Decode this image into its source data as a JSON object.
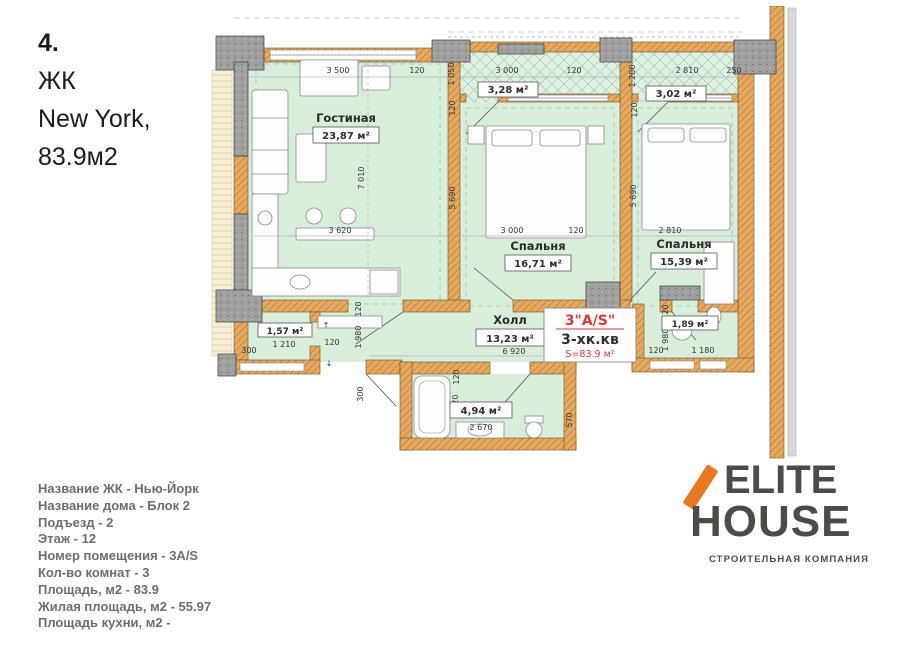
{
  "title": {
    "number": "4.",
    "lines": [
      "ЖК",
      "New York,",
      "83.9м2"
    ]
  },
  "plan": {
    "rooms": {
      "living": {
        "name": "Гостиная",
        "area": "23,87 м²"
      },
      "bedroom1": {
        "name": "Спальня",
        "area": "16,71 м²"
      },
      "bedroom2": {
        "name": "Спальня",
        "area": "15,39 м²"
      },
      "hall": {
        "name": "Холл",
        "area": "13,23 м²"
      },
      "balcony1": {
        "area": "3,28 м²"
      },
      "balcony2": {
        "area": "3,02 м²"
      },
      "storage": {
        "area": "1,57 м²"
      },
      "bathroom": {
        "area": "4,94 м²"
      },
      "wc": {
        "area": "1,89 м²"
      }
    },
    "apartment_label": {
      "type": "3\"A/S\"",
      "kind": "3-хк.кв",
      "area": "S=83.9 м²"
    },
    "dims": {
      "top_row": [
        "3 500",
        "120",
        "3 000",
        "120",
        "2 810",
        "250"
      ],
      "top_vert": [
        "1 050",
        "120",
        "1 200",
        "120"
      ],
      "room_row": [
        "3 620",
        "3 000",
        "120",
        "2 810"
      ],
      "room_vert": [
        "7 010",
        "5 690",
        "5 690"
      ],
      "hall_row": [
        "6 920"
      ],
      "hall_vert": [
        "120",
        "1 980",
        "120",
        "1 980"
      ],
      "storage": [
        "1 210",
        "300",
        "120",
        "300"
      ],
      "bath": [
        "2 670",
        "1 920",
        "120",
        "570"
      ],
      "wc": [
        "120",
        "1 180"
      ]
    },
    "arrows": {
      "up": "↑",
      "down": "↓"
    }
  },
  "info": {
    "lines": [
      "Название ЖК - Нью-Йорк",
      "Название дома - Блок 2",
      "Подъезд - 2",
      "Этаж - 12",
      "Номер помещения - 3A/S",
      "Кол-во комнат - 3",
      "Площадь, м2 - 83.9",
      "Жилая площадь, м2 - 55.97",
      "Площадь кухни, м2 -"
    ]
  },
  "logo": {
    "line1": "ELITE",
    "line2": "HOUSE",
    "subtitle": "СТРОИТЕЛЬНАЯ КОМПАНИЯ"
  },
  "colors": {
    "wall_brick": "#e6a95f",
    "concrete": "#a0a0a0",
    "room_fill": "#d8edda",
    "red_accent": "#d9363c",
    "logo_orange": "#e87722",
    "logo_gray": "#4b4b48"
  }
}
